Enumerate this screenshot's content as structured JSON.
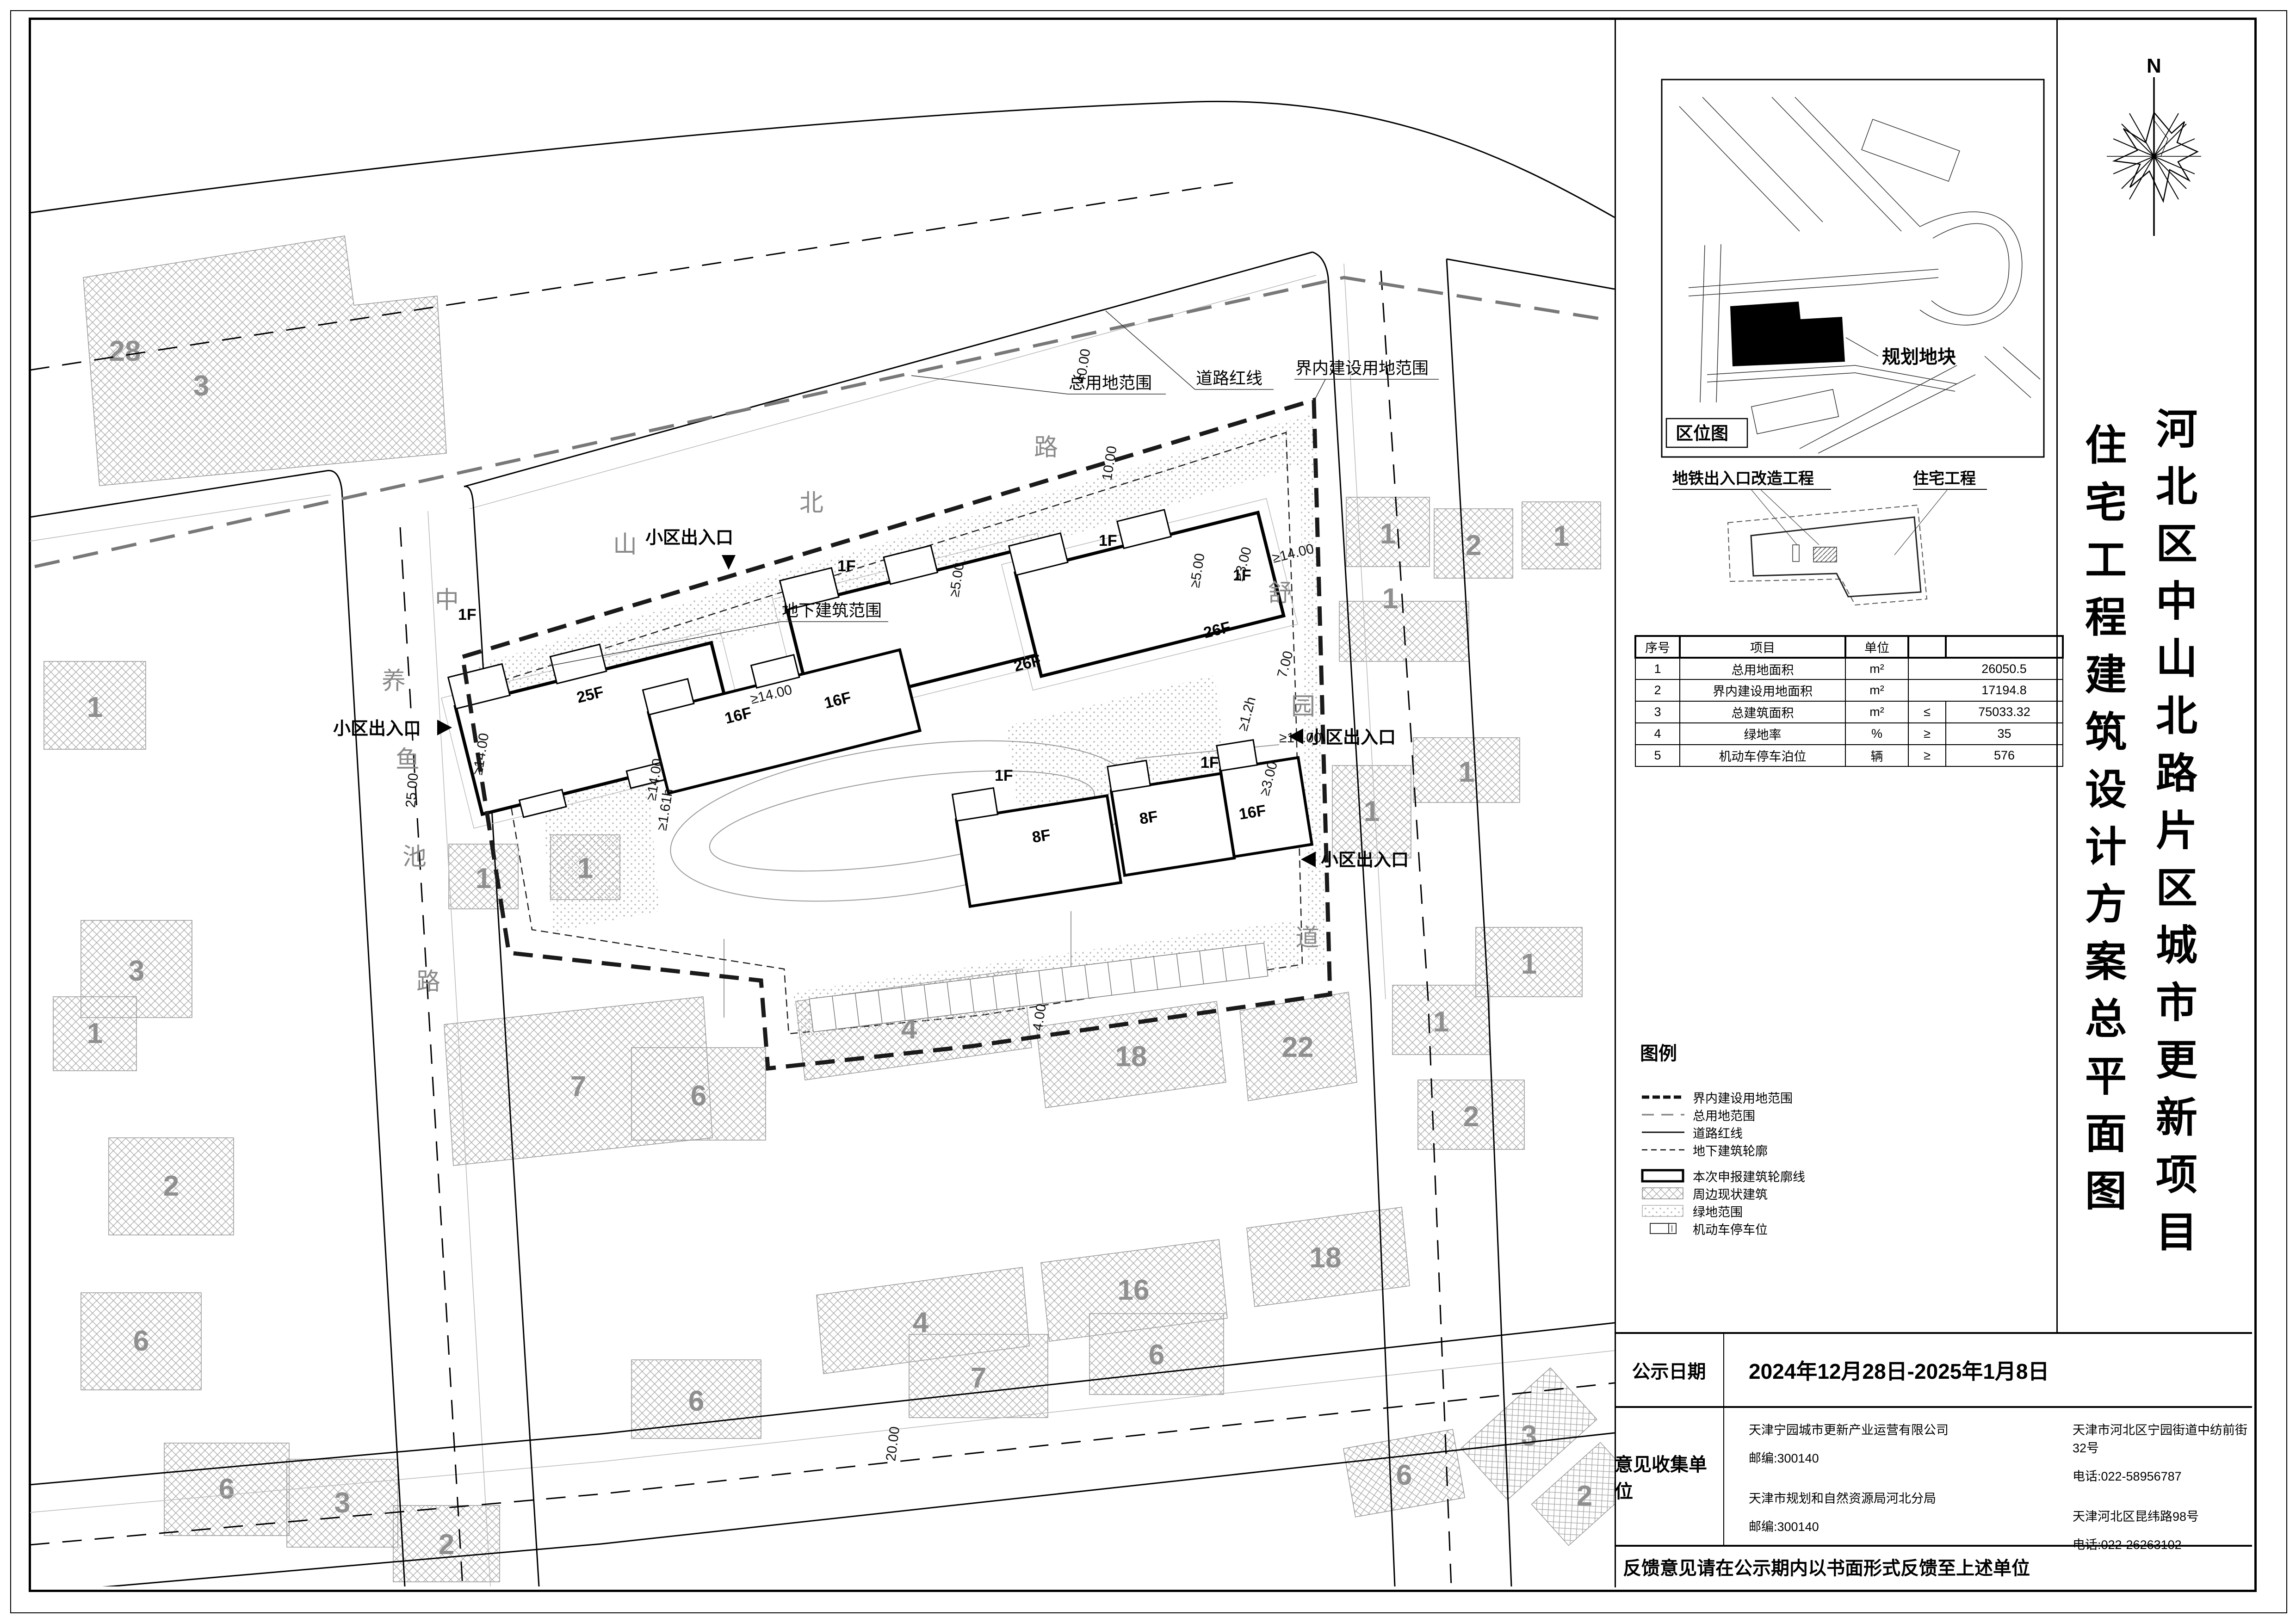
{
  "title_block": {
    "north_label": "N",
    "project_title": "河北区中山北路片区城市更新项目",
    "drawing_title": "住宅工程建筑设计方案总平面图"
  },
  "location_map": {
    "box_label": "区位图",
    "plot_label": "规划地块"
  },
  "scope_map": {
    "metro_label": "地铁出入口改造工程",
    "residential_label": "住宅工程"
  },
  "data_table": {
    "headers": {
      "no": "序号",
      "item": "项目",
      "unit": "单位"
    },
    "rows": [
      {
        "no": "1",
        "item": "总用地面积",
        "unit": "m²",
        "comp": "",
        "value": "26050.5"
      },
      {
        "no": "2",
        "item": "界内建设用地面积",
        "unit": "m²",
        "comp": "",
        "value": "17194.8"
      },
      {
        "no": "3",
        "item": "总建筑面积",
        "unit": "m²",
        "comp": "≤",
        "value": "75033.32"
      },
      {
        "no": "4",
        "item": "绿地率",
        "unit": "%",
        "comp": "≥",
        "value": "35"
      },
      {
        "no": "5",
        "item": "机动车停车泊位",
        "unit": "辆",
        "comp": "≥",
        "value": "576"
      }
    ]
  },
  "legend": {
    "title": "图例",
    "items": [
      {
        "label": "界内建设用地范围"
      },
      {
        "label": "总用地范围"
      },
      {
        "label": "道路红线"
      },
      {
        "label": "地下建筑轮廓"
      },
      {
        "label": "本次申报建筑轮廓线"
      },
      {
        "label": "周边现状建筑"
      },
      {
        "label": "绿地范围"
      },
      {
        "label": "机动车停车位"
      }
    ]
  },
  "notice": {
    "publish_date_label": "公示日期",
    "publish_date": "2024年12月28日-2025年1月8日",
    "feedback_label": "意见收集单位",
    "units": [
      {
        "name": "天津宁园城市更新产业运营有限公司",
        "postcode": "邮编:300140",
        "address": "天津市河北区宁园街道中纺前街32号",
        "phone": "电话:022-58956787"
      },
      {
        "name": "天津市规划和自然资源局河北分局",
        "postcode": "邮编:300140",
        "address": "天津河北区昆纬路98号",
        "phone": "电话:022-26263102"
      }
    ],
    "footer": "反馈意见请在公示期内以书面形式反馈至上述单位"
  },
  "plan": {
    "roads": {
      "north": "中山北路",
      "west": "养鱼池路",
      "east": "舒园道"
    },
    "annotations": {
      "total_site": "总用地范围",
      "road_redline": "道路红线",
      "construction_boundary": "界内建设用地范围",
      "underground": "地下建筑范围"
    },
    "entrance_label": "小区出入口",
    "buildings": {
      "b25f": "25F",
      "b26f": "26F",
      "b16f": "16F",
      "b8f": "8F",
      "annex": "1F"
    },
    "dims": {
      "d40": "40.00",
      "d25": "25.00",
      "d20": "20.00",
      "d10": "10.00",
      "d7": "7.00",
      "d5": "≥5.00",
      "d3": "≥3.00",
      "d14": "≥14.00",
      "d161": "≥1.61h",
      "d12": "≥1.2h",
      "d4": "4.00"
    },
    "existing_numbers": {
      "n1": "1",
      "n2": "2",
      "n3": "3",
      "n4": "4",
      "n6": "6",
      "n7": "7",
      "n16": "16",
      "n18": "18",
      "n22": "22",
      "n28": "28"
    }
  }
}
